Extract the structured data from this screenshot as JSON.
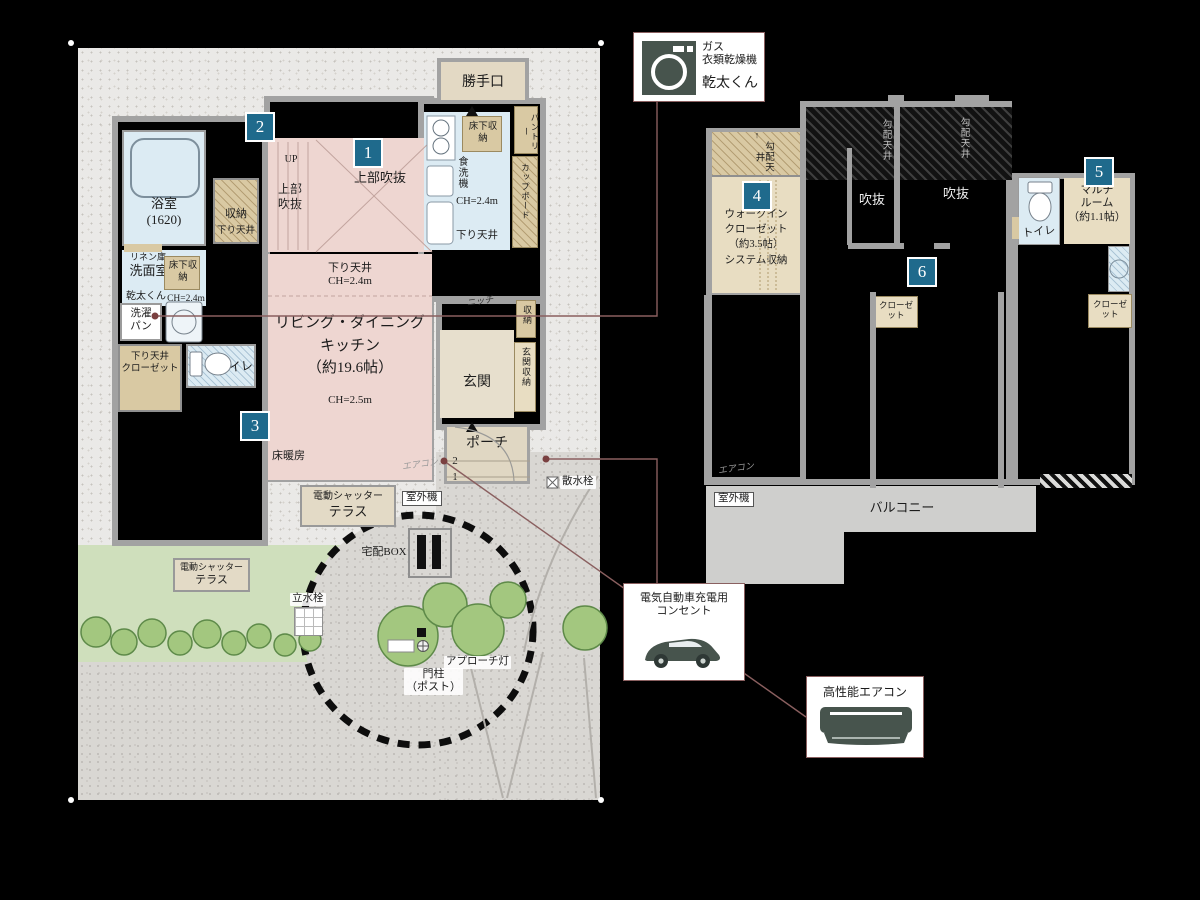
{
  "colors": {
    "badge_teal": "#1f6a8c",
    "connector_maroon": "#8a5f5f",
    "ldk_pink": "#eed6d1",
    "water_blue": "#dcebf3",
    "storage_tan": "#d9c9a3",
    "lawn_green": "#cfdfbc",
    "icon_slate": "#47544d"
  },
  "badges": {
    "n1": "1",
    "n2": "2",
    "n3": "3",
    "n4": "4",
    "n5": "5",
    "n6": "6"
  },
  "f1": {
    "bath": "浴室\n(1620)",
    "stair_storage": "収納",
    "stair_storage_sub": "下り天井",
    "up": "UP",
    "void_side": "上部\n吹抜",
    "void_main": "上部吹抜",
    "back_door": "勝手口",
    "underfloor_storage": "床下収納",
    "pantry": "パントリー",
    "dishwasher": "食洗機",
    "ch_24": "CH=2.4m",
    "lowered_ceiling": "下り天井",
    "cupboard": "カップボード",
    "ldk_ceiling": "下り天井\nCH=2.4m",
    "ldk": "リビング・ダイニング\nキッチン\n（約19.6帖）",
    "ldk_ch": "CH=2.5m",
    "floor_heating": "床暖房",
    "linen": "リネン庫",
    "washroom": "洗面室",
    "kanta_kun": "乾太くん",
    "laundry_pan": "洗濯\nパン",
    "low_closet": "下り天井\nクローゼット",
    "toilet": "トイレ",
    "niche": "ニッチ",
    "hall_storage": "収納",
    "entrance": "玄関",
    "entrance_storage": "玄関収納",
    "porch": "ポーチ",
    "step_2": "2",
    "step_1": "1",
    "aircon": "エアコン",
    "sprinkler": "散水栓",
    "shutter": "電動シャッター",
    "terrace": "テラス",
    "outdoor_unit": "室外機",
    "delivery_box": "宅配BOX",
    "tap": "立水栓",
    "approach_light": "アプローチ灯",
    "gate_post": "門柱\n（ポスト）"
  },
  "f2": {
    "sloped_ceiling": "勾配天井",
    "wic": "ウォークイン\nクローゼット\n（約3.5帖）\nシステム収納",
    "void": "吹抜",
    "toilet": "トイレ",
    "multi_room": "マルチ\nルーム\n（約1.1帖）",
    "closet": "クローゼット",
    "aircon": "エアコン",
    "outdoor_unit": "室外機",
    "balcony": "バルコニー"
  },
  "callouts": {
    "dryer_title": "ガス\n衣類乾燥機",
    "dryer_name": "乾太くん",
    "ev": "電気自動車充電用\nコンセント",
    "aircon": "高性能エアコン"
  }
}
